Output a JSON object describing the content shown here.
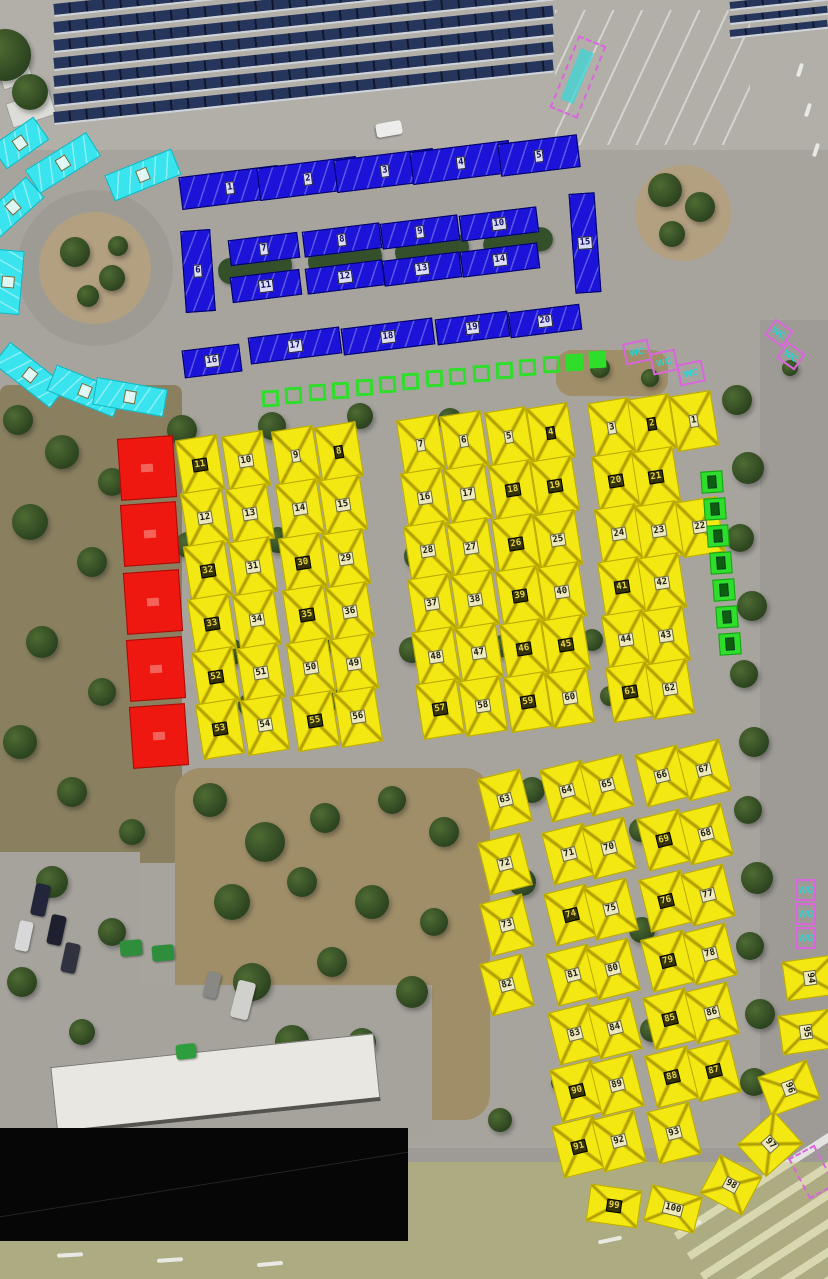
{
  "map": {
    "colors": {
      "yellow_stall": "#f4e812",
      "blue_stall": "#1b13d8",
      "cyan_stall": "#3ae4ee",
      "red_stall": "#ee1810",
      "green_marker": "#2ede2a",
      "magenta_marker": "#d966dd",
      "label_light_bg": "#f3efda",
      "label_dark_bg": "#20200a",
      "label_dark_text": "#e8d44c"
    },
    "stalls": {
      "yellow_top": [
        {
          "n": "11",
          "x": 200,
          "y": 465,
          "dark": true
        },
        {
          "n": "10",
          "x": 246,
          "y": 461
        },
        {
          "n": "9",
          "x": 296,
          "y": 456
        },
        {
          "n": "8",
          "x": 339,
          "y": 452,
          "dark": true
        },
        {
          "n": "7",
          "x": 421,
          "y": 445
        },
        {
          "n": "6",
          "x": 464,
          "y": 441
        },
        {
          "n": "5",
          "x": 509,
          "y": 437
        },
        {
          "n": "4",
          "x": 551,
          "y": 433,
          "dark": true
        },
        {
          "n": "3",
          "x": 612,
          "y": 428
        },
        {
          "n": "2",
          "x": 652,
          "y": 424,
          "dark": true
        },
        {
          "n": "1",
          "x": 694,
          "y": 421
        },
        {
          "n": "12",
          "x": 205,
          "y": 518
        },
        {
          "n": "13",
          "x": 250,
          "y": 514
        },
        {
          "n": "14",
          "x": 300,
          "y": 509
        },
        {
          "n": "15",
          "x": 343,
          "y": 505
        },
        {
          "n": "16",
          "x": 425,
          "y": 498
        },
        {
          "n": "17",
          "x": 468,
          "y": 494
        },
        {
          "n": "18",
          "x": 513,
          "y": 490,
          "dark": true
        },
        {
          "n": "19",
          "x": 555,
          "y": 486,
          "dark": true
        },
        {
          "n": "20",
          "x": 616,
          "y": 481,
          "dark": true
        },
        {
          "n": "21",
          "x": 656,
          "y": 477,
          "dark": true
        },
        {
          "n": "32",
          "x": 208,
          "y": 571,
          "dark": true
        },
        {
          "n": "31",
          "x": 253,
          "y": 567
        },
        {
          "n": "30",
          "x": 303,
          "y": 563,
          "dark": true
        },
        {
          "n": "29",
          "x": 346,
          "y": 559
        },
        {
          "n": "28",
          "x": 428,
          "y": 551
        },
        {
          "n": "27",
          "x": 471,
          "y": 548
        },
        {
          "n": "26",
          "x": 516,
          "y": 544,
          "dark": true
        },
        {
          "n": "25",
          "x": 558,
          "y": 540
        },
        {
          "n": "24",
          "x": 619,
          "y": 534
        },
        {
          "n": "23",
          "x": 659,
          "y": 531
        },
        {
          "n": "22",
          "x": 700,
          "y": 527
        },
        {
          "n": "33",
          "x": 212,
          "y": 624,
          "dark": true
        },
        {
          "n": "34",
          "x": 257,
          "y": 620
        },
        {
          "n": "35",
          "x": 307,
          "y": 615,
          "dark": true
        },
        {
          "n": "36",
          "x": 350,
          "y": 612
        },
        {
          "n": "37",
          "x": 432,
          "y": 604
        },
        {
          "n": "38",
          "x": 475,
          "y": 600
        },
        {
          "n": "39",
          "x": 520,
          "y": 596,
          "dark": true
        },
        {
          "n": "40",
          "x": 562,
          "y": 592
        },
        {
          "n": "41",
          "x": 622,
          "y": 587,
          "dark": true
        },
        {
          "n": "42",
          "x": 662,
          "y": 583
        },
        {
          "n": "52",
          "x": 216,
          "y": 677,
          "dark": true
        },
        {
          "n": "51",
          "x": 261,
          "y": 673
        },
        {
          "n": "50",
          "x": 311,
          "y": 668
        },
        {
          "n": "49",
          "x": 354,
          "y": 664
        },
        {
          "n": "48",
          "x": 436,
          "y": 657
        },
        {
          "n": "47",
          "x": 479,
          "y": 653
        },
        {
          "n": "46",
          "x": 524,
          "y": 649,
          "dark": true
        },
        {
          "n": "45",
          "x": 566,
          "y": 645,
          "dark": true
        },
        {
          "n": "44",
          "x": 626,
          "y": 640
        },
        {
          "n": "43",
          "x": 666,
          "y": 636
        },
        {
          "n": "53",
          "x": 220,
          "y": 729,
          "dark": true
        },
        {
          "n": "54",
          "x": 265,
          "y": 725
        },
        {
          "n": "55",
          "x": 315,
          "y": 721,
          "dark": true
        },
        {
          "n": "56",
          "x": 358,
          "y": 717
        },
        {
          "n": "57",
          "x": 440,
          "y": 709,
          "dark": true
        },
        {
          "n": "58",
          "x": 483,
          "y": 706
        },
        {
          "n": "59",
          "x": 528,
          "y": 702,
          "dark": true
        },
        {
          "n": "60",
          "x": 570,
          "y": 698
        },
        {
          "n": "61",
          "x": 630,
          "y": 692,
          "dark": true
        },
        {
          "n": "62",
          "x": 670,
          "y": 689
        }
      ],
      "yellow_bottom": [
        {
          "n": "63",
          "x": 505,
          "y": 800
        },
        {
          "n": "64",
          "x": 567,
          "y": 791
        },
        {
          "n": "65",
          "x": 607,
          "y": 785
        },
        {
          "n": "66",
          "x": 662,
          "y": 776
        },
        {
          "n": "67",
          "x": 704,
          "y": 770
        },
        {
          "n": "72",
          "x": 505,
          "y": 864
        },
        {
          "n": "71",
          "x": 569,
          "y": 854
        },
        {
          "n": "70",
          "x": 609,
          "y": 848
        },
        {
          "n": "69",
          "x": 664,
          "y": 840,
          "dark": true
        },
        {
          "n": "68",
          "x": 706,
          "y": 834
        },
        {
          "n": "73",
          "x": 507,
          "y": 925
        },
        {
          "n": "74",
          "x": 571,
          "y": 915,
          "dark": true
        },
        {
          "n": "75",
          "x": 611,
          "y": 909
        },
        {
          "n": "76",
          "x": 666,
          "y": 901,
          "dark": true
        },
        {
          "n": "77",
          "x": 708,
          "y": 895
        },
        {
          "n": "82",
          "x": 507,
          "y": 985
        },
        {
          "n": "81",
          "x": 573,
          "y": 975
        },
        {
          "n": "80",
          "x": 613,
          "y": 969
        },
        {
          "n": "79",
          "x": 668,
          "y": 961,
          "dark": true
        },
        {
          "n": "78",
          "x": 710,
          "y": 954
        },
        {
          "n": "83",
          "x": 575,
          "y": 1034
        },
        {
          "n": "84",
          "x": 615,
          "y": 1028
        },
        {
          "n": "85",
          "x": 670,
          "y": 1019,
          "dark": true
        },
        {
          "n": "86",
          "x": 712,
          "y": 1013
        },
        {
          "n": "90",
          "x": 577,
          "y": 1091,
          "dark": true
        },
        {
          "n": "89",
          "x": 617,
          "y": 1085
        },
        {
          "n": "88",
          "x": 672,
          "y": 1077,
          "dark": true
        },
        {
          "n": "87",
          "x": 714,
          "y": 1071,
          "dark": true
        },
        {
          "n": "91",
          "x": 579,
          "y": 1147,
          "dark": true
        },
        {
          "n": "92",
          "x": 619,
          "y": 1141
        },
        {
          "n": "93",
          "x": 674,
          "y": 1133
        }
      ],
      "yellow_edge": [
        {
          "n": "94",
          "x": 810,
          "y": 978,
          "w": 40,
          "h": 52,
          "r": 82
        },
        {
          "n": "95",
          "x": 806,
          "y": 1032,
          "w": 40,
          "h": 52,
          "r": 82
        },
        {
          "n": "96",
          "x": 789,
          "y": 1088,
          "w": 42,
          "h": 52,
          "r": 70
        },
        {
          "n": "97",
          "x": 770,
          "y": 1144,
          "w": 44,
          "h": 50,
          "r": 48
        },
        {
          "n": "98",
          "x": 731,
          "y": 1185,
          "w": 48,
          "h": 44,
          "r": 28
        },
        {
          "n": "99",
          "x": 614,
          "y": 1206,
          "w": 52,
          "h": 38,
          "r": 8,
          "dark": true
        },
        {
          "n": "100",
          "x": 673,
          "y": 1209,
          "w": 52,
          "h": 38,
          "r": 14
        }
      ],
      "blue": [
        {
          "n": "1",
          "x": 230,
          "y": 187
        },
        {
          "n": "2",
          "x": 308,
          "y": 178
        },
        {
          "n": "3",
          "x": 385,
          "y": 170
        },
        {
          "n": "4",
          "x": 461,
          "y": 162
        },
        {
          "n": "5",
          "x": 539,
          "y": 155,
          "w": 80
        },
        {
          "n": "6",
          "x": 198,
          "y": 271,
          "w": 30,
          "h": 82,
          "r": -4
        },
        {
          "n": "7",
          "x": 264,
          "y": 249,
          "w": 70,
          "h": 26
        },
        {
          "n": "8",
          "x": 342,
          "y": 240,
          "w": 78,
          "h": 26
        },
        {
          "n": "9",
          "x": 420,
          "y": 232,
          "w": 78,
          "h": 26
        },
        {
          "n": "10",
          "x": 499,
          "y": 224,
          "w": 78,
          "h": 26
        },
        {
          "n": "11",
          "x": 266,
          "y": 286,
          "w": 70,
          "h": 26
        },
        {
          "n": "12",
          "x": 345,
          "y": 277,
          "w": 78,
          "h": 26
        },
        {
          "n": "13",
          "x": 422,
          "y": 269,
          "w": 78,
          "h": 26
        },
        {
          "n": "14",
          "x": 500,
          "y": 260,
          "w": 78,
          "h": 26
        },
        {
          "n": "15",
          "x": 585,
          "y": 243,
          "w": 26,
          "h": 100,
          "r": -4
        },
        {
          "n": "16",
          "x": 212,
          "y": 361,
          "w": 58,
          "h": 28
        },
        {
          "n": "17",
          "x": 295,
          "y": 345,
          "w": 92,
          "h": 27
        },
        {
          "n": "18",
          "x": 388,
          "y": 336,
          "w": 92,
          "h": 27
        },
        {
          "n": "19",
          "x": 472,
          "y": 328,
          "w": 73,
          "h": 26
        },
        {
          "n": "20",
          "x": 545,
          "y": 321,
          "w": 72,
          "h": 26
        }
      ],
      "cyan": [
        {
          "x": 20,
          "y": 143,
          "r": -35,
          "w": 52
        },
        {
          "x": 63,
          "y": 163,
          "r": -32
        },
        {
          "x": 143,
          "y": 175,
          "r": -22
        },
        {
          "x": 13,
          "y": 207,
          "r": -42,
          "w": 60
        },
        {
          "x": 8,
          "y": 282,
          "r": -85,
          "w": 64
        },
        {
          "x": 30,
          "y": 375,
          "r": 38
        },
        {
          "x": 85,
          "y": 391,
          "r": 22
        },
        {
          "x": 130,
          "y": 397,
          "r": 10
        }
      ],
      "red": [
        {
          "x": 147,
          "y": 468
        },
        {
          "x": 150,
          "y": 534
        },
        {
          "x": 153,
          "y": 602
        },
        {
          "x": 156,
          "y": 669
        },
        {
          "x": 159,
          "y": 736
        }
      ],
      "green_row": [
        {
          "x": 270,
          "y": 398
        },
        {
          "x": 293,
          "y": 395
        },
        {
          "x": 317,
          "y": 392
        },
        {
          "x": 340,
          "y": 390
        },
        {
          "x": 364,
          "y": 387
        },
        {
          "x": 387,
          "y": 384
        },
        {
          "x": 410,
          "y": 381
        },
        {
          "x": 434,
          "y": 378
        },
        {
          "x": 457,
          "y": 376
        },
        {
          "x": 481,
          "y": 373
        },
        {
          "x": 504,
          "y": 370
        },
        {
          "x": 527,
          "y": 367
        },
        {
          "x": 551,
          "y": 364
        },
        {
          "x": 574,
          "y": 362,
          "filled": true
        },
        {
          "x": 597,
          "y": 359,
          "filled": true
        }
      ],
      "green_col": [
        {
          "x": 712,
          "y": 482
        },
        {
          "x": 715,
          "y": 509
        },
        {
          "x": 718,
          "y": 536
        },
        {
          "x": 721,
          "y": 563
        },
        {
          "x": 724,
          "y": 590
        },
        {
          "x": 727,
          "y": 617
        },
        {
          "x": 730,
          "y": 644
        }
      ],
      "wc_markers": [
        {
          "x": 578,
          "y": 77,
          "w": 30,
          "h": 78,
          "r": 22,
          "dashed": true,
          "inner": true
        },
        {
          "x": 637,
          "y": 352,
          "w": 26,
          "h": 22,
          "r": -12,
          "label": "WC"
        },
        {
          "x": 664,
          "y": 362,
          "w": 26,
          "h": 22,
          "r": -12,
          "label": "WC"
        },
        {
          "x": 691,
          "y": 373,
          "w": 26,
          "h": 22,
          "r": -12,
          "label": "WC"
        },
        {
          "x": 779,
          "y": 333,
          "w": 22,
          "h": 20,
          "r": 35,
          "label": "WC"
        },
        {
          "x": 791,
          "y": 356,
          "w": 22,
          "h": 20,
          "r": 35,
          "label": "WC"
        },
        {
          "x": 806,
          "y": 890,
          "w": 20,
          "h": 22,
          "r": 0,
          "label": "WC"
        },
        {
          "x": 806,
          "y": 914,
          "w": 20,
          "h": 22,
          "r": 0,
          "label": "WC"
        },
        {
          "x": 806,
          "y": 938,
          "w": 20,
          "h": 22,
          "r": 0,
          "label": "WC"
        },
        {
          "x": 812,
          "y": 1172,
          "w": 30,
          "h": 46,
          "r": -28,
          "dashed": true
        }
      ]
    }
  }
}
